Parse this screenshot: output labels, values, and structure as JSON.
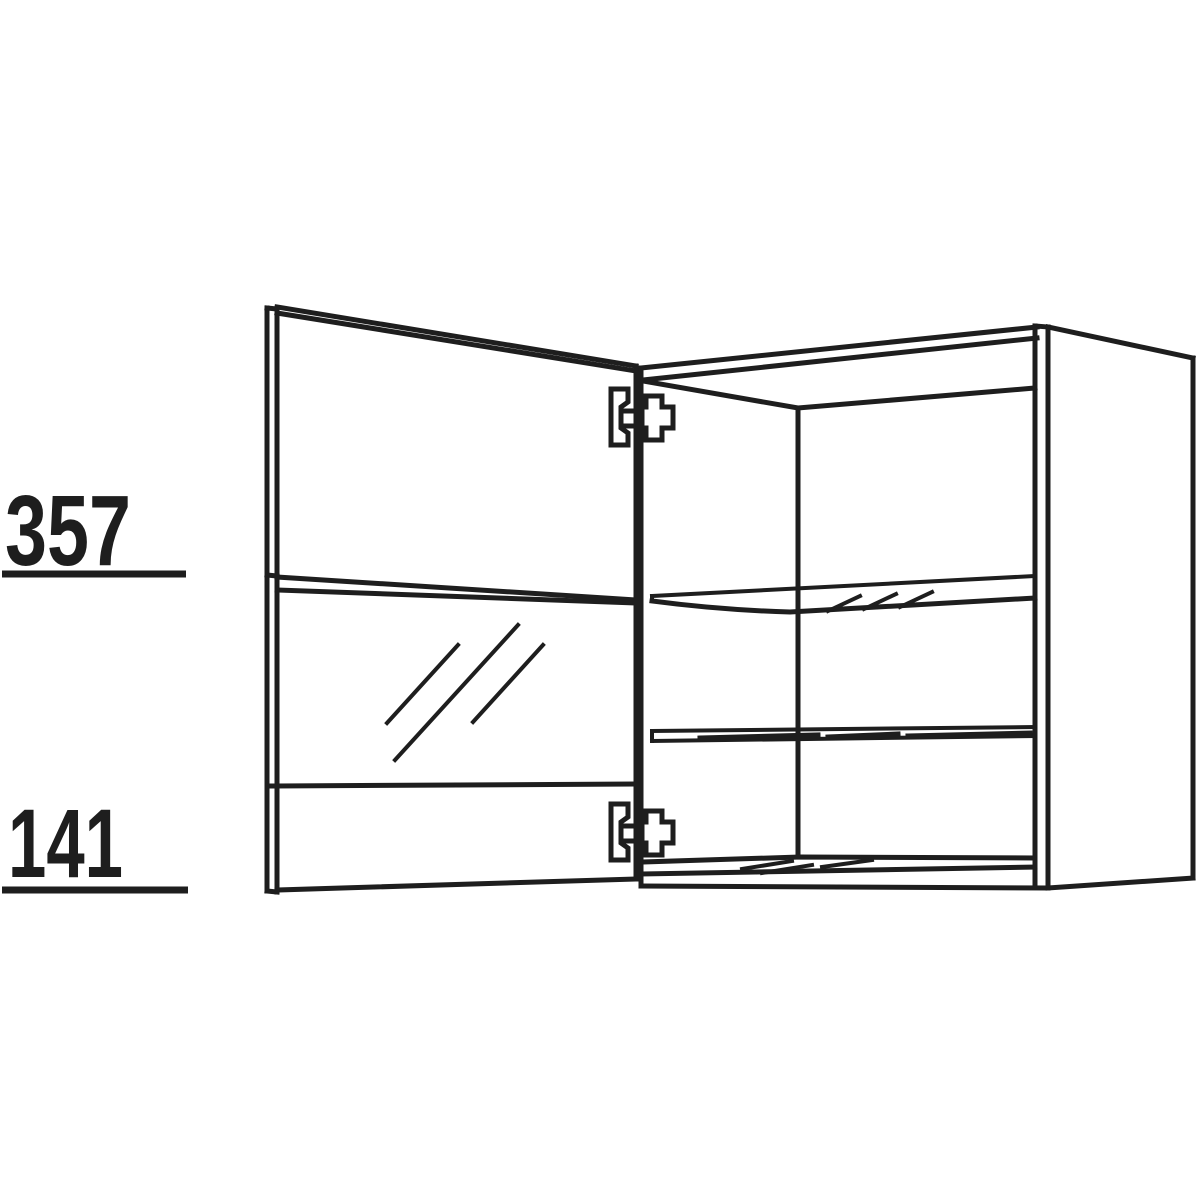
{
  "canvas": {
    "width": 1200,
    "height": 1200,
    "background": "#ffffff",
    "line_color": "#1e1e1e"
  },
  "diagram": {
    "type": "furniture-technical-line-drawing",
    "subject": "Wall cabinet with open glass door, one glass shelf, one wooden shelf and two concealed hinges",
    "dimension_labels": [
      {
        "value": "357",
        "position": "upper-left",
        "underlined": true
      },
      {
        "value": "141",
        "position": "lower-left",
        "underlined": true
      }
    ]
  }
}
